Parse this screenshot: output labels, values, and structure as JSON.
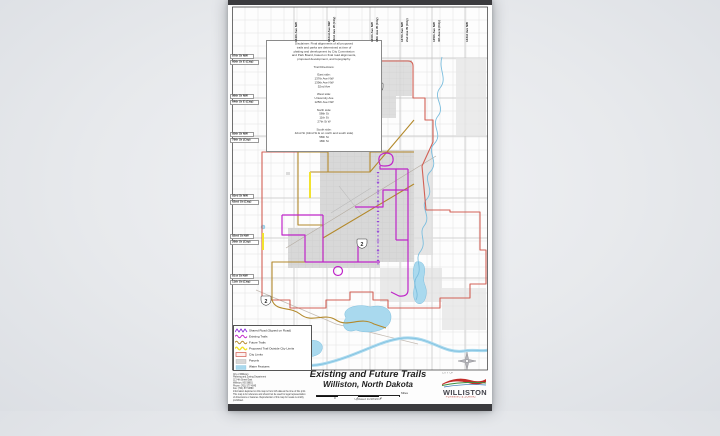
{
  "map": {
    "route_shield": "2",
    "colors": {
      "city_limits": "#d0594d",
      "existing_trail": "#bf26c9",
      "future_trail": "#b3892b",
      "proposed_trail": "#f2e22e",
      "shared_road": "#8a2bd8",
      "water_fill": "#a9d9ee",
      "water_line": "#7cbede",
      "parcel": "#d8d8d8"
    },
    "title": {
      "line1": "Existing and Future Trails",
      "line2": "Williston, North Dakota",
      "updated": "Updated 11/28/2017"
    },
    "scalebar": {
      "t0": "0",
      "t1": "1",
      "t2": "2",
      "unit": "Miles"
    },
    "disclaimer": {
      "lines": [
        "Disclaimer: Final alignments of all proposed",
        "trails and parks are determined at time of",
        "platting and development by City Commission",
        "and Park Board, based on final road alignments,",
        "proposed development, and topography.",
        "",
        "Trail Directions:",
        "",
        "East side:",
        "137th Ave NW",
        "139th Ave NW",
        "52nd Ave",
        "",
        "West side:",
        "University Ave",
        "125th Ave NW",
        "",
        "North side:",
        "58th St",
        "11th St",
        "27th St W",
        "",
        "South side:",
        "42nd St (42nd St E on north and south side)",
        "58th St",
        "18th St"
      ]
    },
    "legend": {
      "items": [
        {
          "label": "Shared Road (Signed on Road)"
        },
        {
          "label": "Existing Trails"
        },
        {
          "label": "Future Trails"
        },
        {
          "label": "Proposed Trail Outside City Limits"
        },
        {
          "label": "City Limits"
        },
        {
          "label": "Parcels"
        },
        {
          "label": "Water Features"
        }
      ]
    },
    "top_roads": [
      {
        "road": "144th Ave NW",
        "city": ""
      },
      {
        "road": "142nd Ave NW",
        "city": "52nd Ave W (City)"
      },
      {
        "road": "140th Ave NW",
        "city": "18th Ave W (City)"
      },
      {
        "road": "137th Ave NW",
        "city": "2nd Ave W (City)"
      },
      {
        "road": "135th Ave NW",
        "city": "4th Ave E (City)"
      },
      {
        "road": "133rd Ave NW",
        "city": ""
      }
    ],
    "left_roads": [
      {
        "road": "87th St NW",
        "city": "60th St E (City)"
      },
      {
        "road": "86th St NW",
        "city": "64th St E (City)"
      },
      {
        "road": "85th St NW",
        "city": "78th St (City)"
      },
      {
        "road": "83rd St NW",
        "city": "62nd St (City)"
      },
      {
        "road": "82nd St NW",
        "city": "26th St (City)"
      },
      {
        "road": "81st St NW",
        "city": "11th St (City)"
      }
    ],
    "credits": {
      "lines": [
        "City of Williston",
        "Planning and Zoning Department",
        "113 4th Street East",
        "Williston, ND 58801",
        "Phone: (701) 577-4545",
        "Fax: (701) 577-8880",
        "Information depicted on this map is from GIS data at the time of this print.",
        "This map is for reference and should not be used for legal representation",
        "of dimensions or features. Reproduction of this map for resale is strictly",
        "prohibited."
      ]
    },
    "logo": {
      "city_of": "CITY OF",
      "name": "WILLISTON",
      "dept": "PLANNING & ZONING"
    }
  }
}
